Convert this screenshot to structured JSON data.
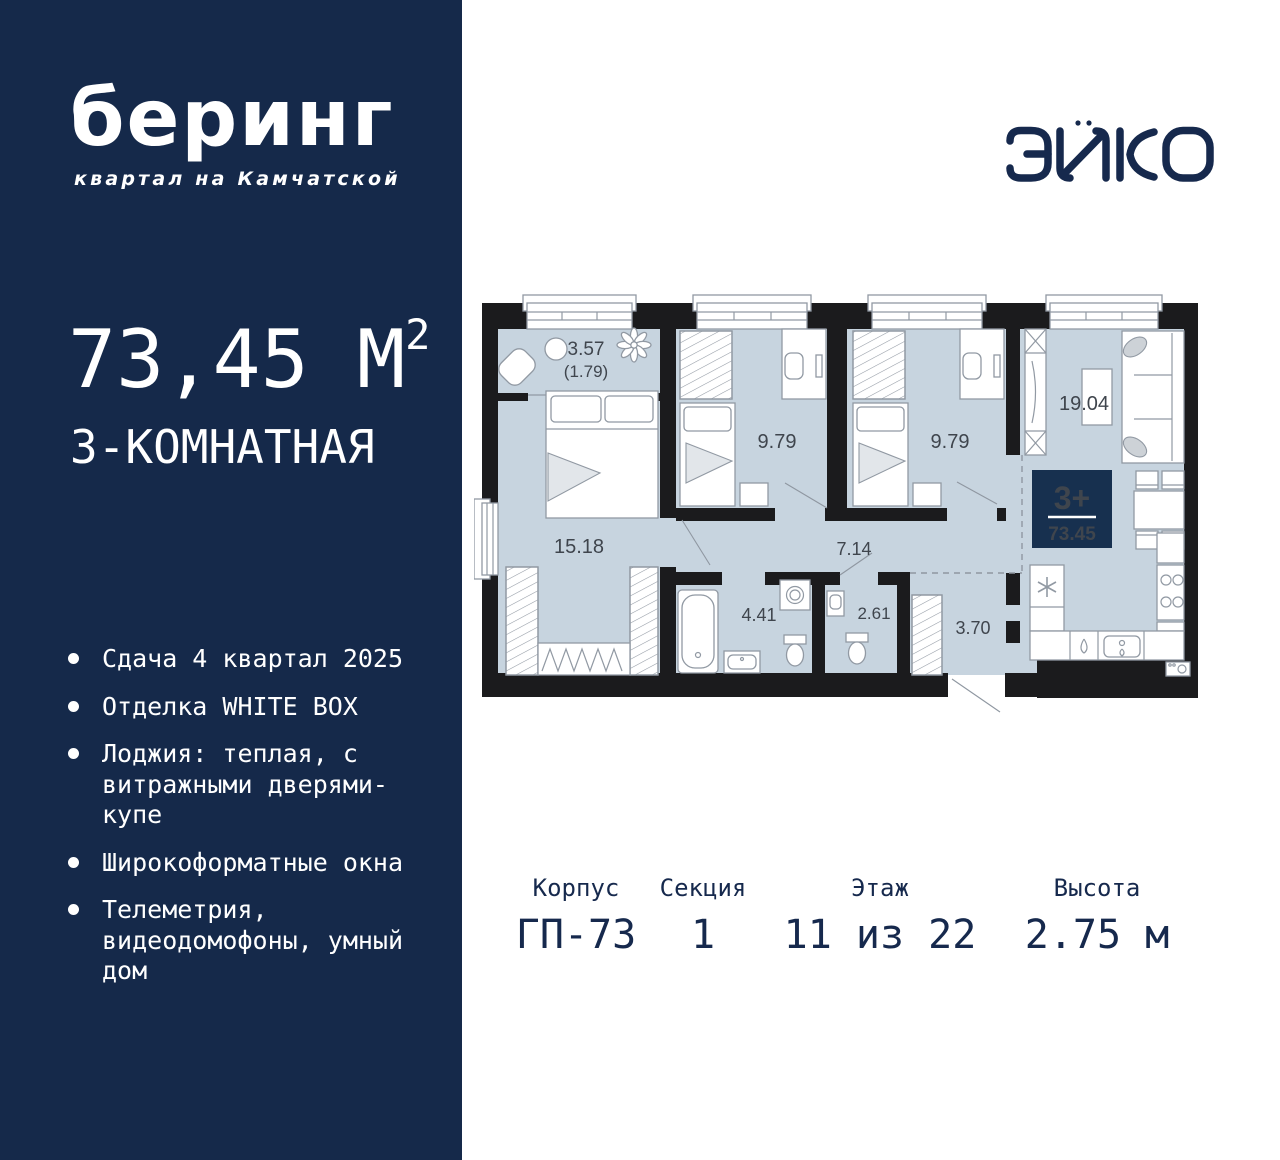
{
  "colors": {
    "navy": "#15294A",
    "badge_navy": "#17304F",
    "floor": "#C7D4DF",
    "wall": "#1B1B1D",
    "accent_text": "#16294D"
  },
  "sidebar": {
    "logo": "беринг",
    "logo_subtitle": "квартал на Камчатской",
    "area_value": "73,45",
    "area_unit": "М",
    "area_sup": "2",
    "type_label": "3-КОМНАТНАЯ",
    "features": [
      "Сдача 4 квартал 2025",
      "Отделка WHITE BOX",
      "Лоджия: теплая, с витражными дверями-купе",
      "Широкоформатные окна",
      "Телеметрия, видеодомофоны, умный дом"
    ]
  },
  "brand": {
    "name": "ЭНКО"
  },
  "plan": {
    "rooms": [
      {
        "name": "loggia",
        "label": "3.57"
      },
      {
        "name": "loggia-reduced",
        "label": "(1.79)"
      },
      {
        "name": "bedroom-1",
        "label": "9.79"
      },
      {
        "name": "bedroom-2",
        "label": "9.79"
      },
      {
        "name": "living-kitchen",
        "label": "19.04"
      },
      {
        "name": "bedroom-master",
        "label": "15.18"
      },
      {
        "name": "hallway",
        "label": "7.14"
      },
      {
        "name": "bathroom",
        "label": "4.41"
      },
      {
        "name": "wc",
        "label": "2.61"
      },
      {
        "name": "entry",
        "label": "3.70"
      }
    ],
    "badge": {
      "rooms": "3+",
      "area": "73.45"
    }
  },
  "footer": {
    "columns": [
      {
        "label": "Корпус",
        "value": "ГП-73"
      },
      {
        "label": "Секция",
        "value": "1"
      },
      {
        "label": "Этаж",
        "value": "11 из 22"
      },
      {
        "label": "Высота",
        "value": "2.75 м"
      }
    ]
  }
}
